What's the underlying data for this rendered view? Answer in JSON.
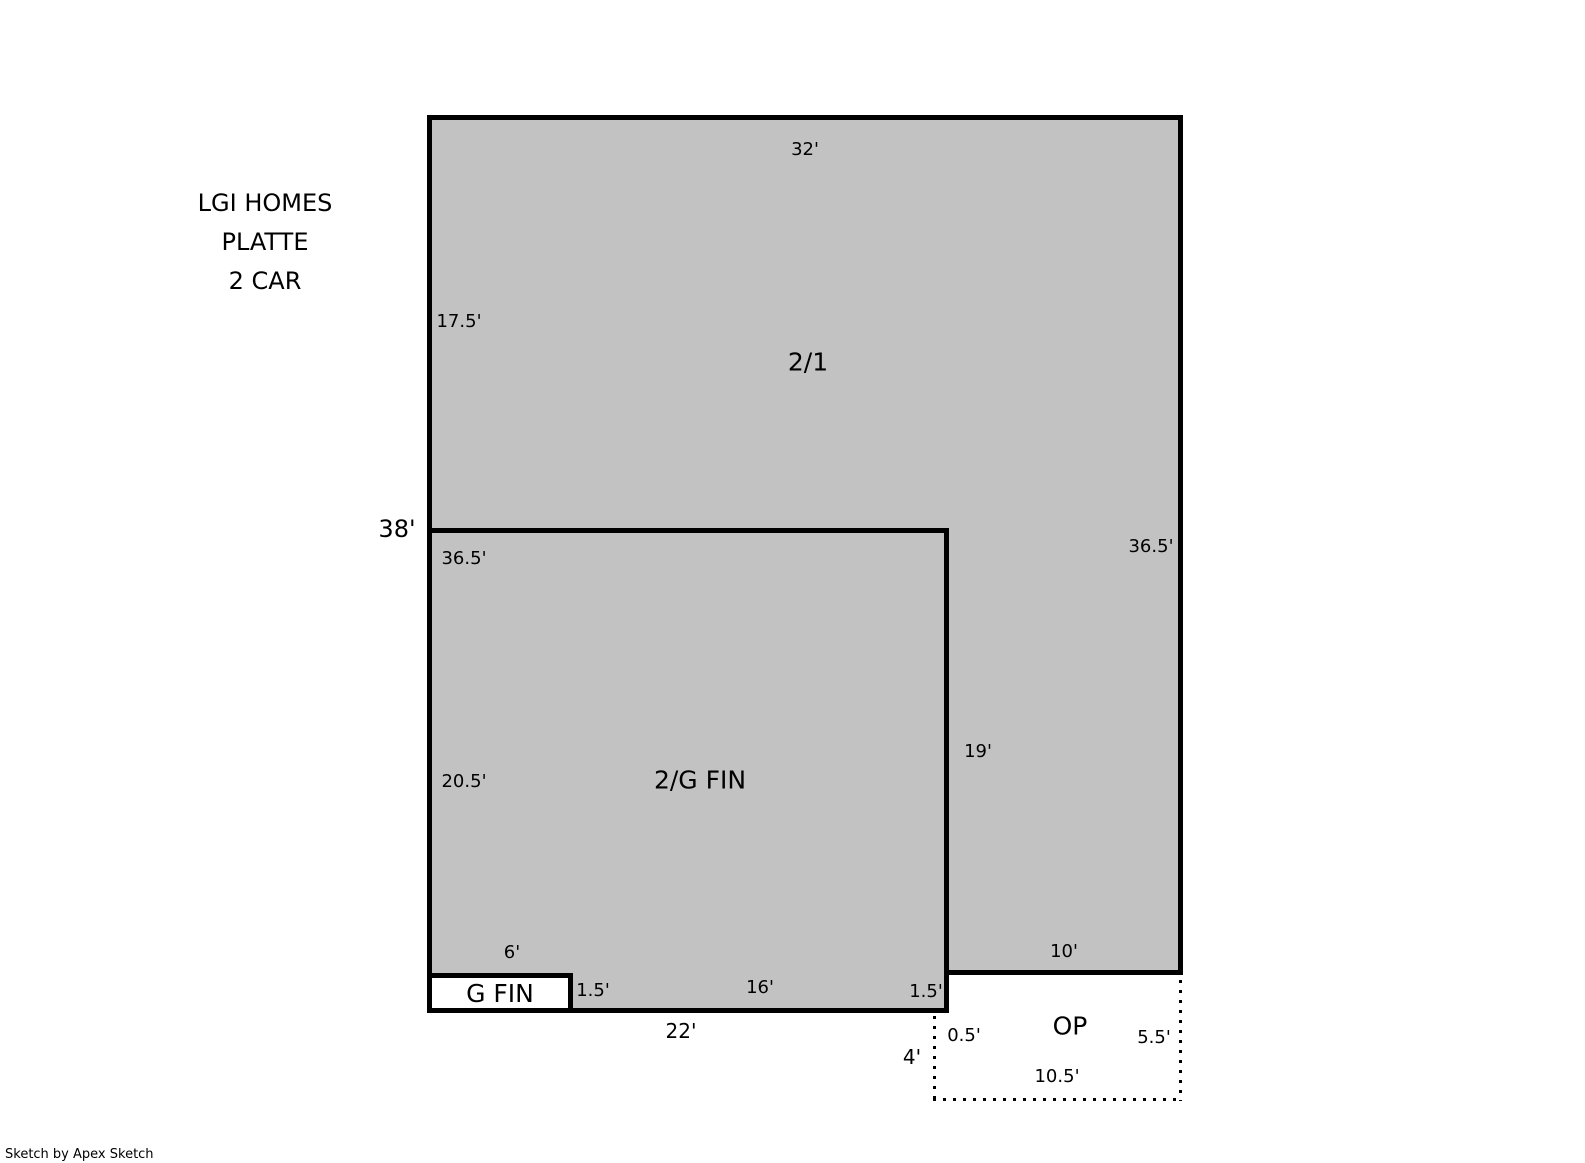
{
  "title_block": {
    "line1": "LGI HOMES",
    "line2": "PLATTE",
    "line3": "2 CAR"
  },
  "areas": {
    "main": {
      "label": "2/1"
    },
    "lower": {
      "label": "2/G FIN"
    },
    "garage_strip": {
      "label": "G FIN"
    },
    "open_porch": {
      "label": "OP"
    }
  },
  "dimensions": {
    "main_top": "32'",
    "main_left_upper": "17.5'",
    "overall_left": "38'",
    "main_inner_left": "36.5'",
    "main_right": "36.5'",
    "lower_left": "20.5'",
    "step_right": "19'",
    "garage_width": "6'",
    "garage_depth": "1.5'",
    "lower_bottom_mid": "16'",
    "lower_bottom_step": "1.5'",
    "lower_bottom_total": "22'",
    "porch_top": "10'",
    "porch_left": "4'",
    "porch_inset": "0.5'",
    "porch_right": "5.5'",
    "porch_bottom": "10.5'"
  },
  "footer": {
    "credit": "Sketch by Apex Sketch"
  },
  "colors": {
    "area_fill": "#c2c2c2",
    "outline": "#000000",
    "background": "#ffffff"
  }
}
